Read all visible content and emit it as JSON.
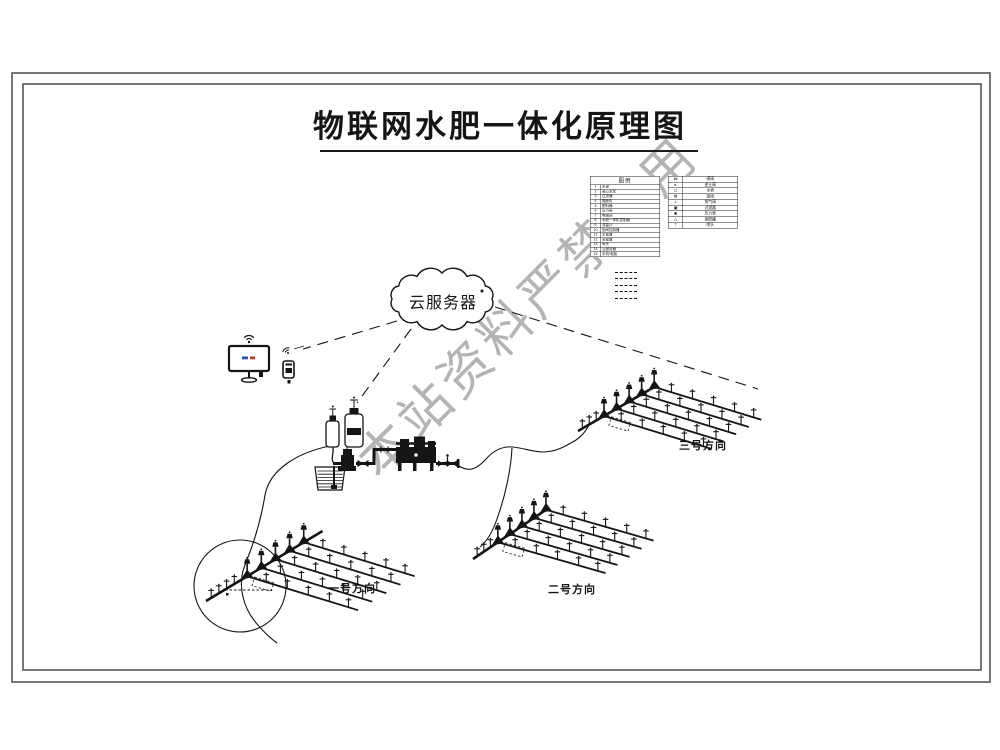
{
  "title": "物联网水肥一体化原理图",
  "watermark": "本站资料严禁盗用",
  "cloud": {
    "label": "云服务器"
  },
  "fields": [
    {
      "label": "一号方向"
    },
    {
      "label": "二号方向"
    },
    {
      "label": "三号方向"
    }
  ],
  "legend": {
    "header": "图例",
    "left_rows": [
      [
        "1",
        "水源"
      ],
      [
        "2",
        "离心水泵"
      ],
      [
        "3",
        "过滤器"
      ],
      [
        "4",
        "施肥机"
      ],
      [
        "5",
        "肥料桶"
      ],
      [
        "6",
        "压力表"
      ],
      [
        "7",
        "电磁阀"
      ],
      [
        "8",
        "水肥一体机控制器"
      ],
      [
        "9",
        "流量计"
      ],
      [
        "10",
        "田间控制器"
      ],
      [
        "11",
        "主管道"
      ],
      [
        "12",
        "支管道"
      ],
      [
        "13",
        "喷头"
      ],
      [
        "14",
        "云服务器"
      ],
      [
        "15",
        "手机/电脑"
      ]
    ],
    "right_rows": [
      [
        "⋈",
        "闸阀"
      ],
      [
        "▸",
        "逆止阀"
      ],
      [
        "◻",
        "水表"
      ],
      [
        "⊠",
        "球阀"
      ],
      [
        "⊥",
        "排气阀"
      ],
      [
        "▣",
        "过滤器"
      ],
      [
        "◉",
        "压力表"
      ],
      [
        "△",
        "施肥罐"
      ],
      [
        "⊤",
        "喷头"
      ]
    ],
    "line_sample_count": 5
  },
  "colors": {
    "ink": "#151515",
    "frame": "#4a4a4a",
    "watermark": "#868686",
    "screen_blue": "#2b50b8",
    "screen_red": "#b83a2b"
  }
}
